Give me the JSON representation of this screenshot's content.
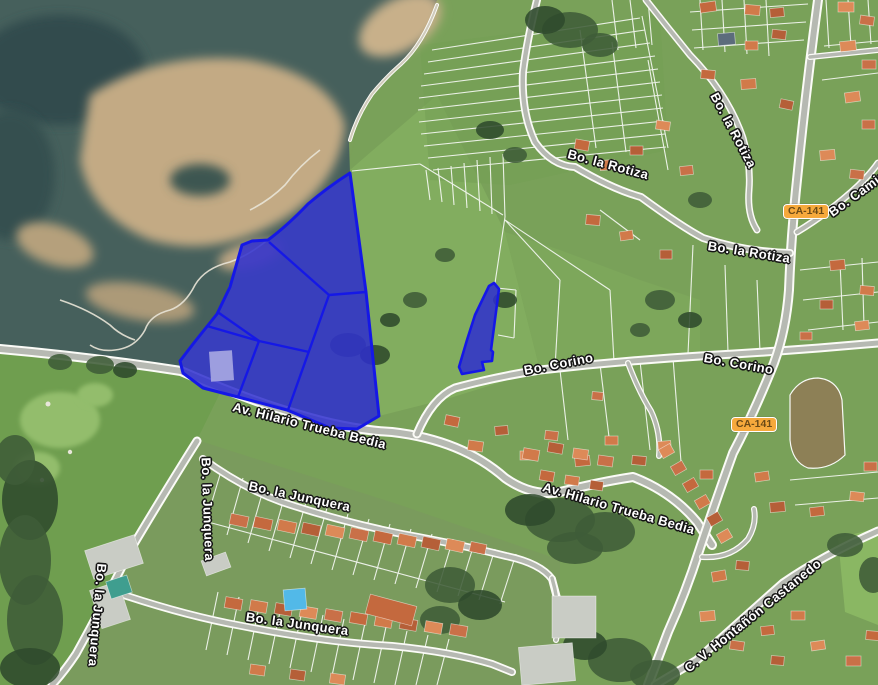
{
  "map": {
    "highlight_color": "#1518e6",
    "route_badge": "CA-141",
    "labels": {
      "rotiza": "Bo. la Rotiza",
      "corino": "Bo. Corino",
      "camino": "Bo. Camino",
      "hilario": "Av. Hilario Trueba Bedia",
      "junquera": "Bo. la Junquera",
      "hontanon": "C. V. Hontañón Castanedo"
    }
  }
}
